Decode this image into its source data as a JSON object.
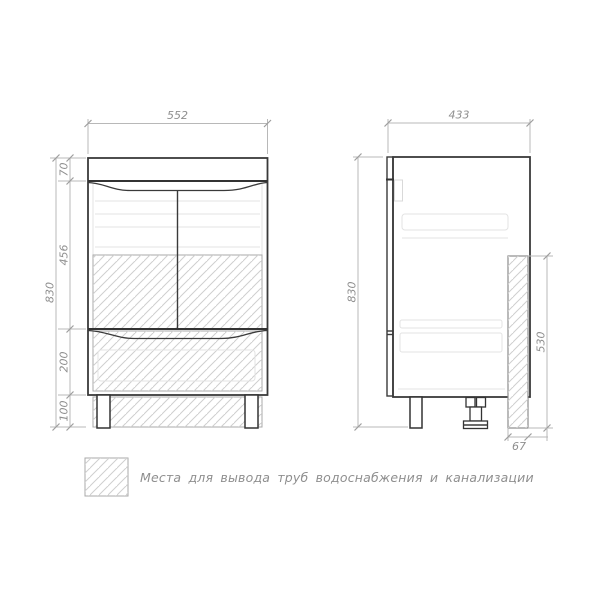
{
  "front_view": {
    "width": "552",
    "total_height": "830",
    "top_section_height": "70",
    "door_section_height": "456",
    "drawer_section_height": "200",
    "leg_height": "100"
  },
  "side_view": {
    "depth": "433",
    "total_height": "830",
    "pipe_zone_height": "530",
    "pipe_zone_depth": "67"
  },
  "legend": {
    "note": "Места для вывода труб водоснабжения и канализации",
    "swatch": "hatch-swatch"
  },
  "colors": {
    "outline": "#3a3a3a",
    "dimension_line": "#b8b8b8",
    "dimension_text": "#8f8f8f",
    "hatch_line": "#cfcfcf",
    "background": "#ffffff"
  }
}
